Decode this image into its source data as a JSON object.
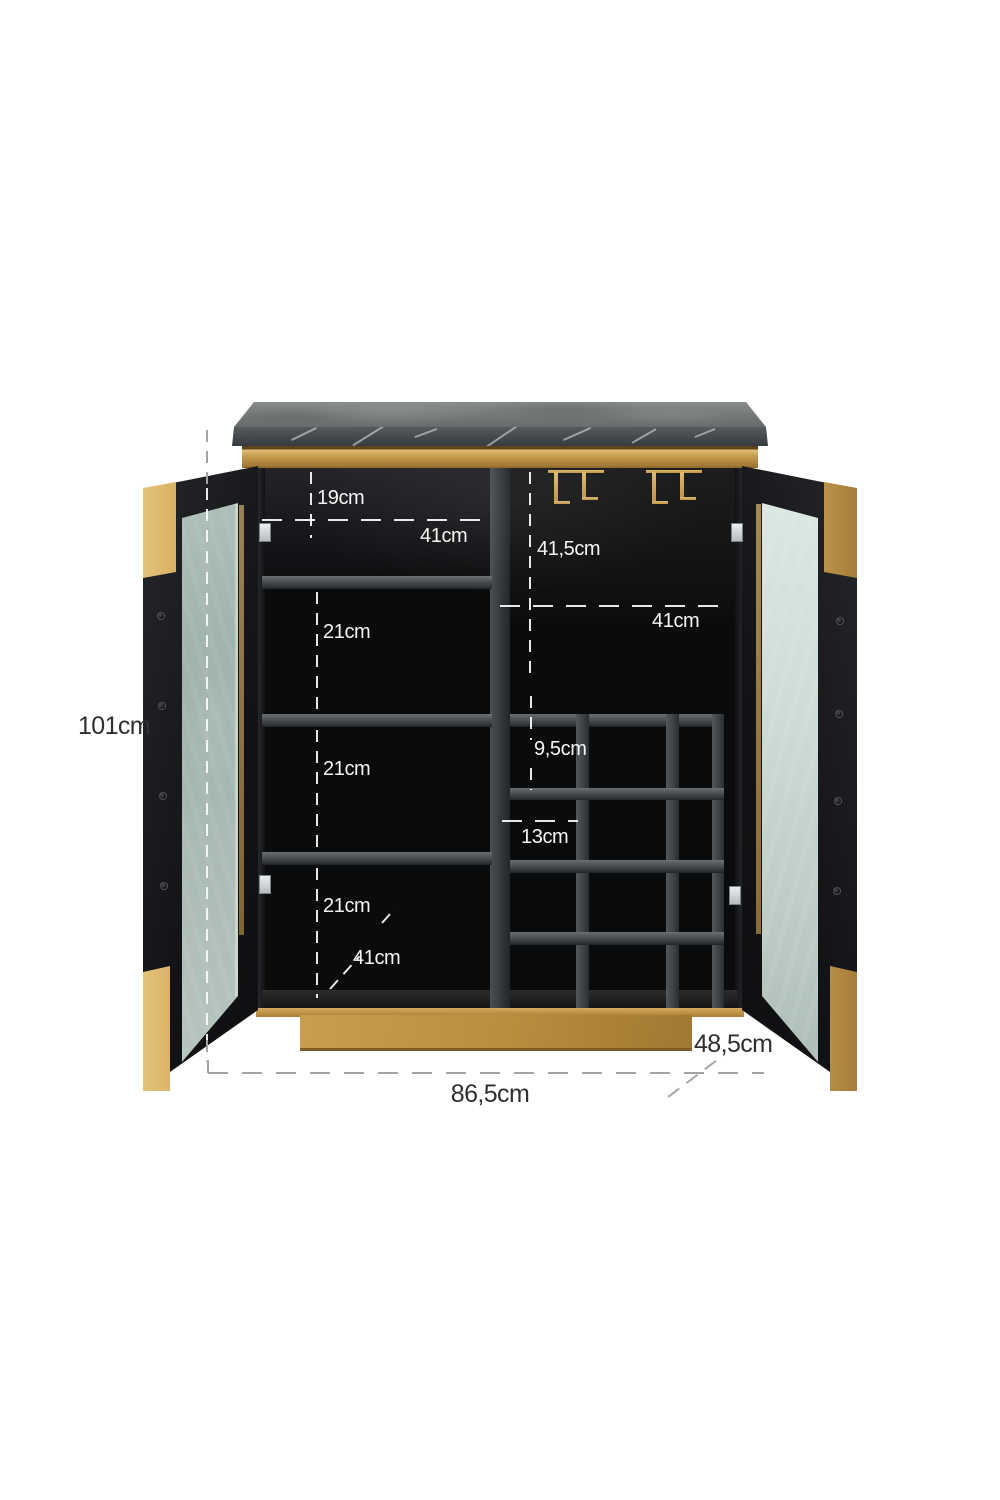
{
  "diagram": {
    "title": "Bar cabinet with open glass doors, marble top and wine rack — dimension diagram",
    "dimensions": {
      "overall_height": "101cm",
      "overall_width": "86,5cm",
      "overall_depth": "48,5cm",
      "top_compartment_height": "19cm",
      "left_compartment_width": "41cm",
      "right_compartment_height": "41,5cm",
      "right_compartment_width": "41cm",
      "shelf_spacing_upper": "21cm",
      "shelf_spacing_middle": "21cm",
      "shelf_spacing_lower": "21cm",
      "wine_cubby_height": "9,5cm",
      "wine_cubby_width": "13cm",
      "interior_depth": "41cm"
    },
    "colors": {
      "gold": "#c79e52",
      "marble_top": "#747877",
      "marble_face": "#45484b",
      "cabinet_black": "#0a0b0d",
      "glass_left": "#a9bcb3",
      "glass_right": "#d5e2dc",
      "annotation_light": "#f5f5f5",
      "annotation_dark": "#2e2f30",
      "background": "#ffffff"
    }
  }
}
